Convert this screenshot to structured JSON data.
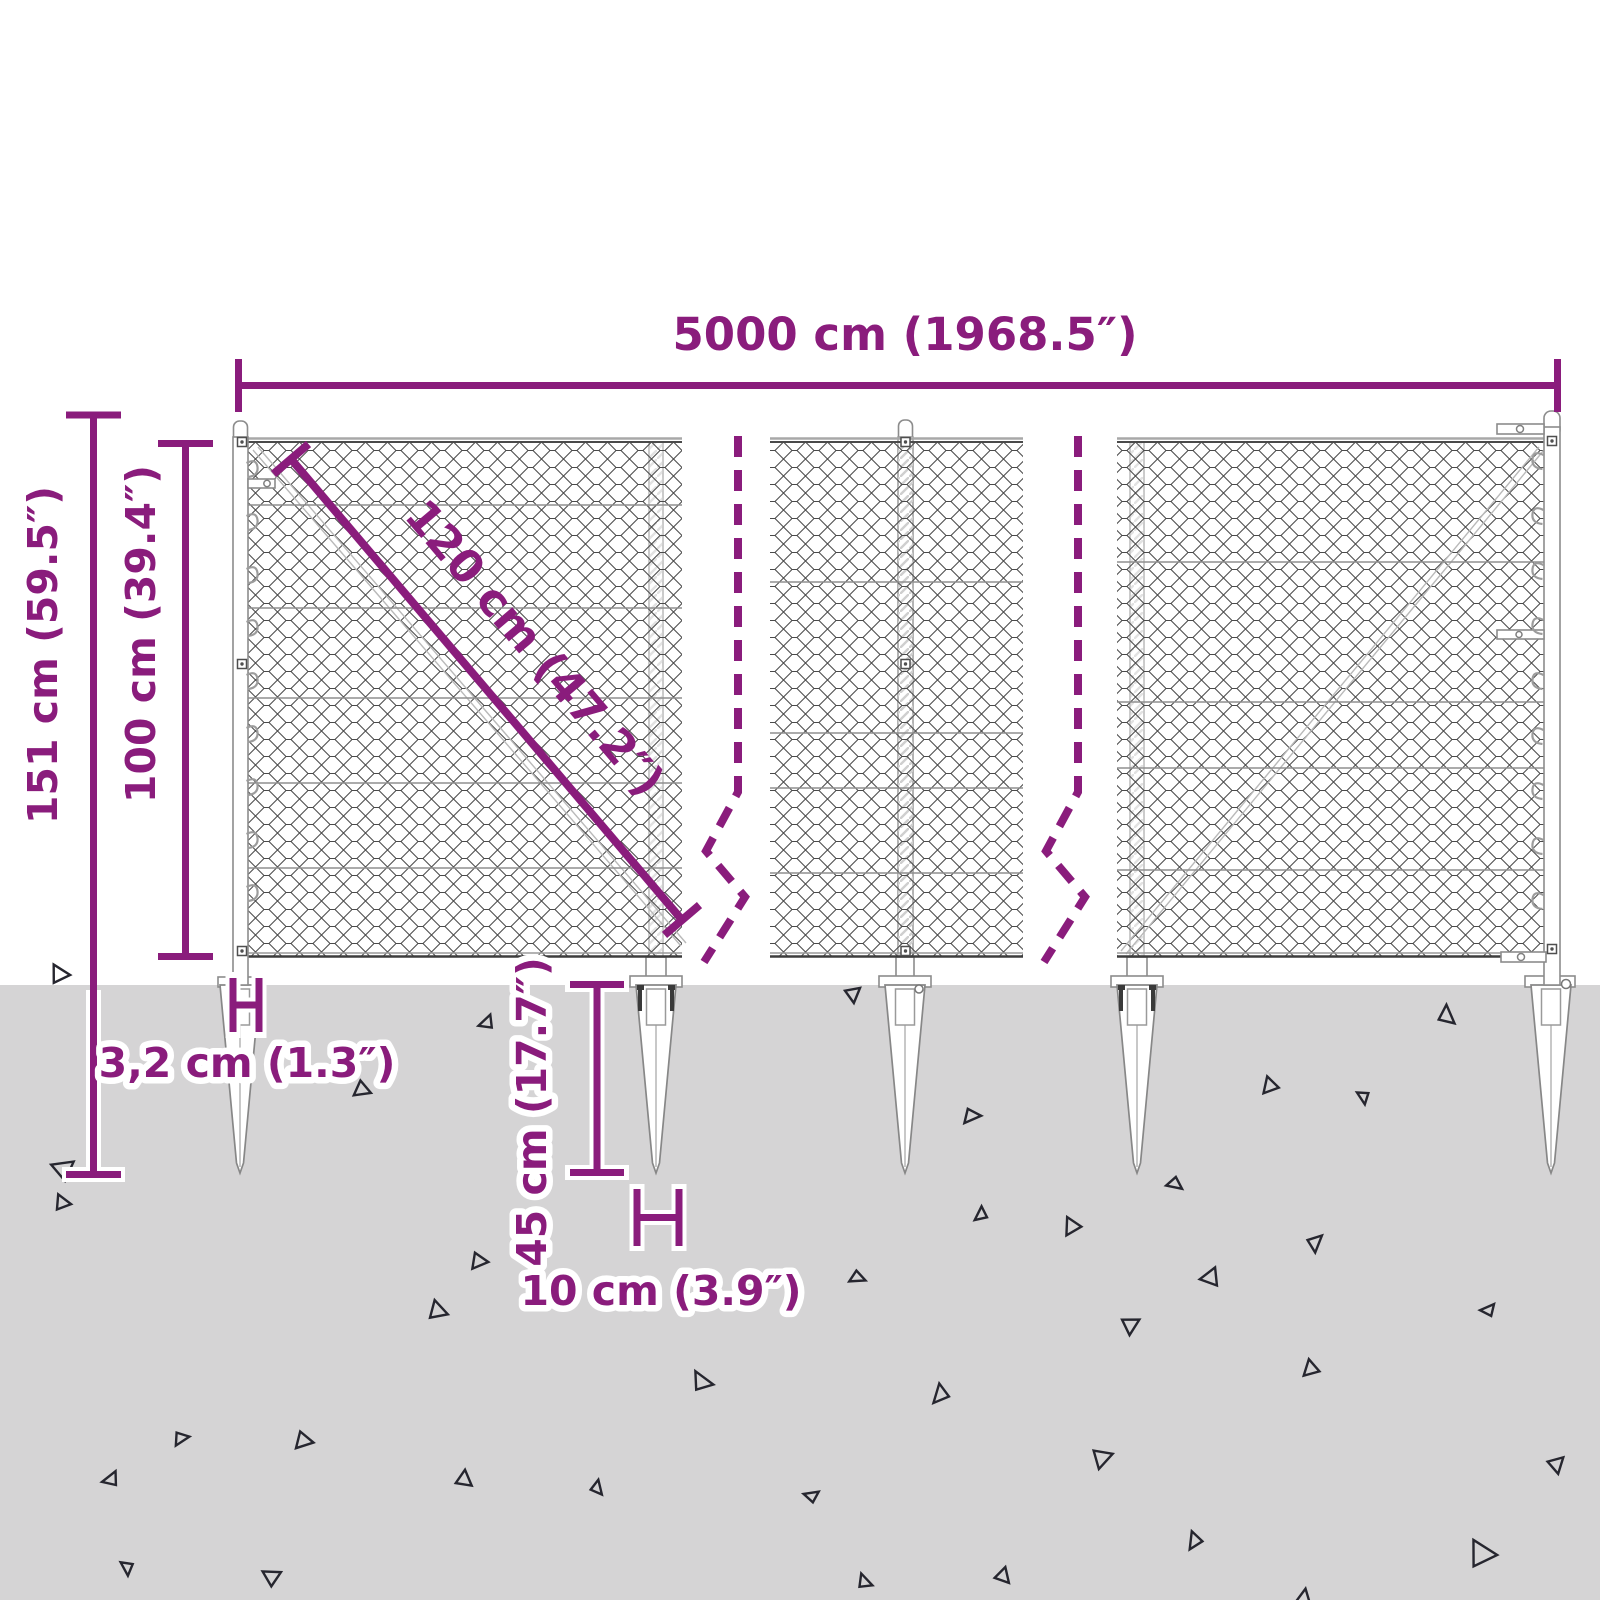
{
  "diagram": {
    "type": "product-dimension-diagram",
    "subject": "chain-link wire mesh fence with ground anchor spikes",
    "labels": {
      "total_width": "5000 cm (1968.5″)",
      "total_height": "151 cm (59.5″)",
      "mesh_height": "100 cm (39.4″)",
      "diagonal": "120 cm (47.2″)",
      "post_diameter": "3,2 cm (1.3″)",
      "spike_length": "45 cm (17.7″)",
      "spike_width": "10 cm (3.9″)"
    },
    "colors": {
      "accent": "#8a1c7c",
      "ground": "#d5d4d5",
      "mesh_line": "#4a4a4a",
      "hardware_line": "#8c8c8c",
      "triangle": "#26262f",
      "background": "#ffffff"
    }
  }
}
